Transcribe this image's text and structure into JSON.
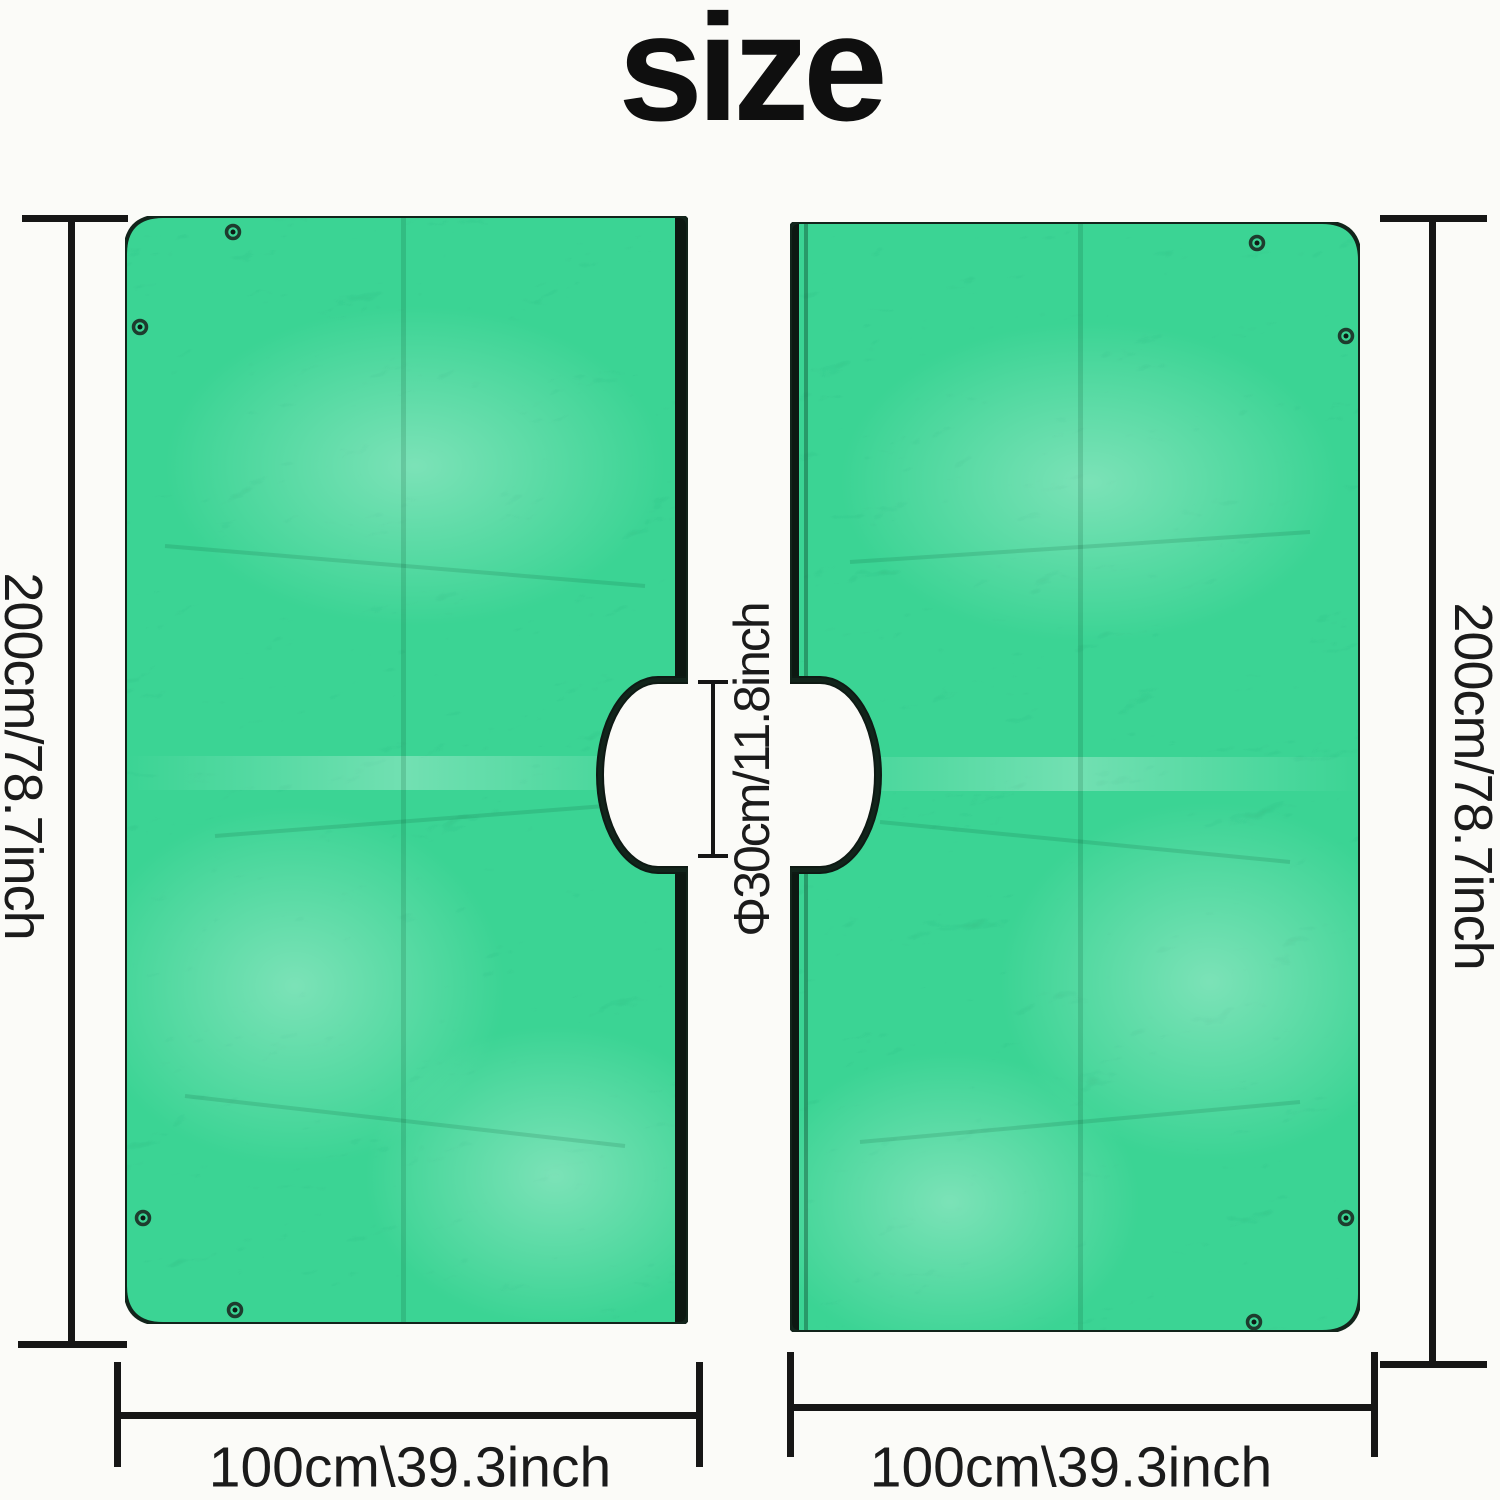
{
  "title": "size",
  "colors": {
    "tarp_green": "#3ad494",
    "edge_black": "#12241b",
    "stripe_black": "#0d1812",
    "line_black": "#161616",
    "background": "#fbfbf8"
  },
  "panels": {
    "left": {
      "height_label": "200cm/78.7inch",
      "width_label": "100cm\\39.3inch"
    },
    "right": {
      "height_label": "200cm/78.7inch",
      "width_label": "100cm\\39.3inch"
    }
  },
  "hole": {
    "diameter_label": "Φ30cm/11.8inch"
  }
}
